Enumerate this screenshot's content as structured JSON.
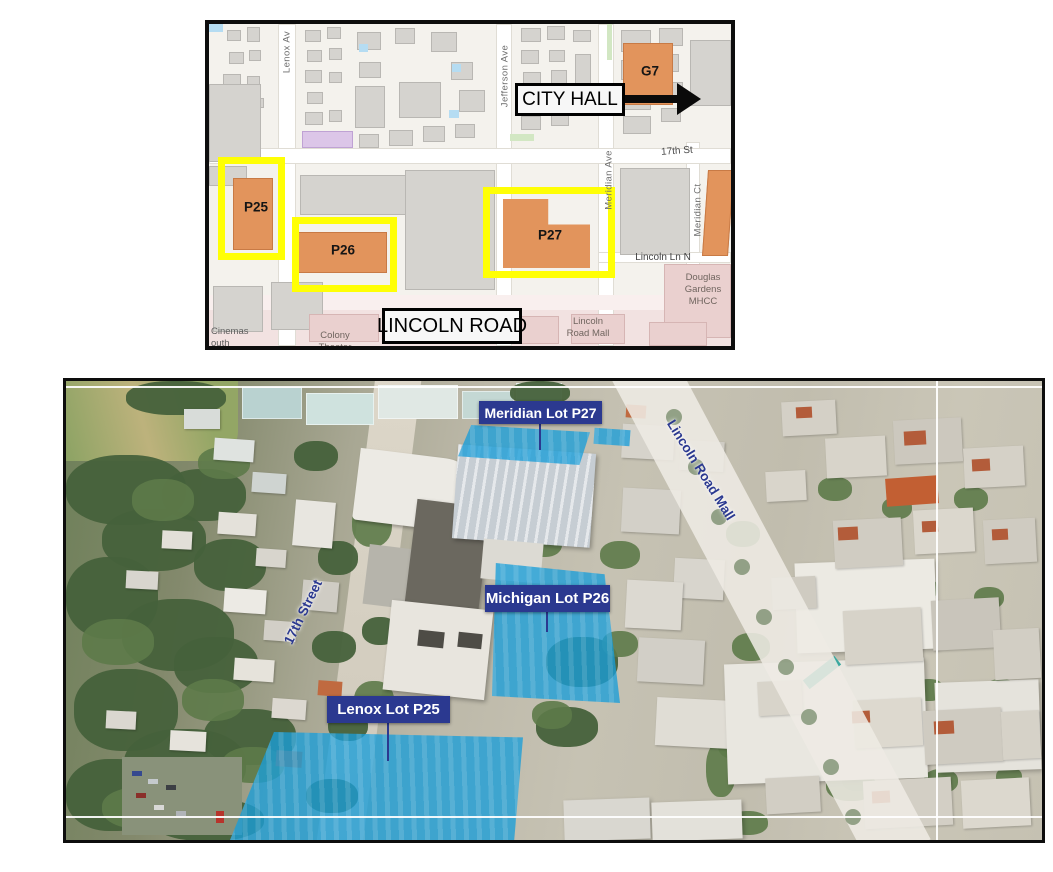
{
  "map": {
    "streets": {
      "lenox": "Lenox Av",
      "jefferson": "Jefferson Ave",
      "meridian_ave": "Meridian Ave",
      "meridian_ct": "Meridian Ct",
      "seventeenth": "17th St",
      "lincoln_ln": "Lincoln Ln N"
    },
    "parcels": {
      "p25": "P25",
      "p26": "P26",
      "p27": "P27",
      "g7": "G7"
    },
    "callouts": {
      "city_hall": "CITY HALL",
      "lincoln_road": "LINCOLN ROAD"
    },
    "places": {
      "douglas_gardens": "Douglas\nGardens\nMHCC",
      "lincoln_road_mall": "Lincoln\nRoad Mall",
      "colony_theater": "Colony\nTheater",
      "cinemas_edge": "Cinemas\nouth"
    }
  },
  "aerial": {
    "lot_labels": [
      {
        "text": "Meridian Lot P27"
      },
      {
        "text": "Michigan Lot P26"
      },
      {
        "text": "Lenox Lot P25"
      }
    ],
    "streets": {
      "seventeenth": "17th Street",
      "lincoln_mall": "Lincoln Road Mall"
    }
  },
  "colors": {
    "parcel_orange": "#e2945c",
    "highlight_yellow": "#ffff05",
    "label_navy": "#2b3990",
    "lot_blue": "#199ed9"
  }
}
